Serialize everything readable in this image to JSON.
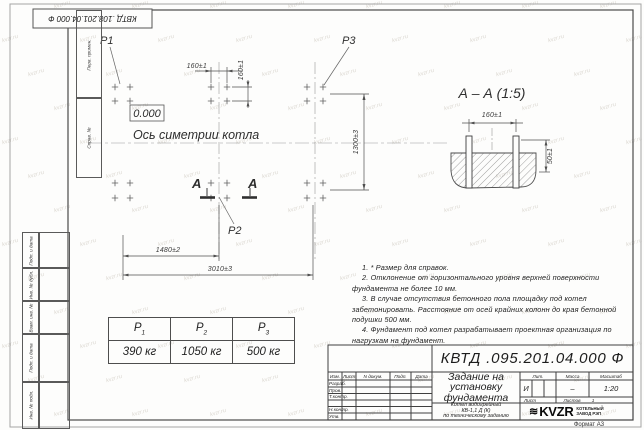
{
  "page": {
    "format_label": "Формат А3"
  },
  "corner_stamp": {
    "designation": "КВТД .108.201.04.000  Ф"
  },
  "margin": {
    "top_labels": [
      "Перв. примен.",
      "Справ. №"
    ],
    "bottom_labels": [
      "Подп. и дата",
      "Инв. № дубл.",
      "Взам. инв. №",
      "Подп. и дата",
      "Инв. № подл."
    ]
  },
  "plan": {
    "elevation_mark": "0.000",
    "axis_label": "Ось симетрии котла",
    "labels": {
      "p1": "P1",
      "p2": "P2",
      "p3": "P3"
    },
    "dims": {
      "d160h": "160±1",
      "d160v": "160±1",
      "d1300": "1300±3",
      "d1480": "1480±2",
      "d3010": "3010±3"
    },
    "section_letter": "А",
    "bolt_columns_px": [
      115,
      130,
      211,
      227,
      307,
      323
    ],
    "bolt_rows_px": [
      87,
      101,
      183,
      198
    ]
  },
  "section_view": {
    "title": "А – А (1:5)",
    "dim_top": "160±1",
    "dim_right": "50±1"
  },
  "loads_table": {
    "p1": {
      "name": "P",
      "sub": "1",
      "value": "390 кг"
    },
    "p2": {
      "name": "P",
      "sub": "2",
      "value": "1050 кг"
    },
    "p3": {
      "name": "P",
      "sub": "3",
      "value": "500 кг"
    }
  },
  "notes": [
    "1. * Размер для справок.",
    "2. Отклонение от горизонтального уровня верхней поверхности фундамента не более 10 мм.",
    "3. В случае отсутствия бетонного пола площадку под котел забетонировать. Расстояние от осей крайних колонн до края бетонной подушки 500 мм.",
    "4. Фундамент под котел разрабатывает проектная организация по нагрузкам на фундамент."
  ],
  "title_block": {
    "designation": "КВТД .095.201.04.000  Ф",
    "doc_title_lines": [
      "Задание на",
      "установку",
      "фундамента"
    ],
    "subtitle_lines": [
      "Котел водогрейный",
      "КВ-1,1 Д (К)",
      "по техническому заданию"
    ],
    "header_cols": [
      "Изм.",
      "Лист",
      "N докум.",
      "Подп.",
      "Дата"
    ],
    "sign_rows": [
      "Разраб.",
      "Пров.",
      "Т.контр.",
      "",
      "Н.контр.",
      "Утв."
    ],
    "lit": {
      "label": "Лит.",
      "value": "И"
    },
    "mass": {
      "label": "Масса",
      "value": "–"
    },
    "scale": {
      "label": "Масштаб",
      "value": "1:20"
    },
    "sheet": {
      "label": "Лист",
      "value": ""
    },
    "sheets": {
      "label": "Листов",
      "value": "1"
    },
    "company": {
      "logo_glyph": "≋",
      "logo_text": "KVZR",
      "name_line1": "КОТЕЛЬНЫЙ",
      "name_line2": "ЗАВОД РЭП"
    }
  },
  "watermark": {
    "text": "kvzr.ru"
  }
}
